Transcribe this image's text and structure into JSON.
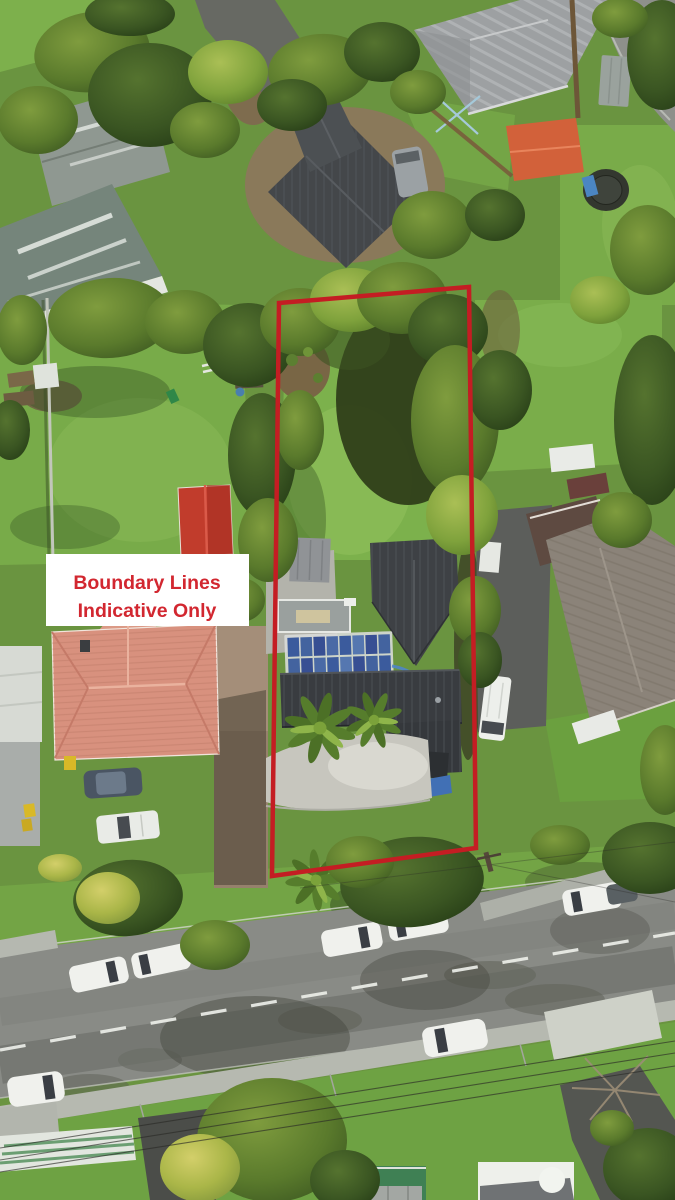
{
  "overlay": {
    "boundary": {
      "points": "279,303 469,287 476,848 272,876",
      "color": "#c41d23",
      "stroke_width": "4.5"
    },
    "label": {
      "line1": "Boundary Lines",
      "line2": "Indicative Only",
      "text_color": "#d22730",
      "box_color": "#ffffff"
    }
  },
  "scene": {
    "type": "aerial-drone-photo",
    "features": [
      "red property boundary outline",
      "boundary disclaimer label",
      "main house with dark roof and blue solar panels",
      "gravel courtyard and palm trees",
      "long backyard lawn with trees",
      "salmon tile roof neighbour house",
      "red gable outbuilding",
      "orange roof shed",
      "trampoline and clothesline",
      "street with white parked cars and dashed centerline",
      "footpaths, driveways, power lines, hedges"
    ],
    "palette": {
      "lawn": "#74a344",
      "lawn_bright": "#82b350",
      "tree_dark": "#33511f",
      "tree_mid": "#4f7329",
      "tree_light": "#7ca03b",
      "tree_yellow": "#a8b249",
      "road": "#8a8c87",
      "footpath": "#b6b9b0",
      "main_roof": "#393c40",
      "solar_panel": "#3d5da0",
      "salmon_roof": "#d8917e",
      "red_roof": "#c33a2c",
      "orange_roof": "#d2613a",
      "grey_roof": "#9da0a2",
      "car_white": "#f0f1ed"
    }
  }
}
